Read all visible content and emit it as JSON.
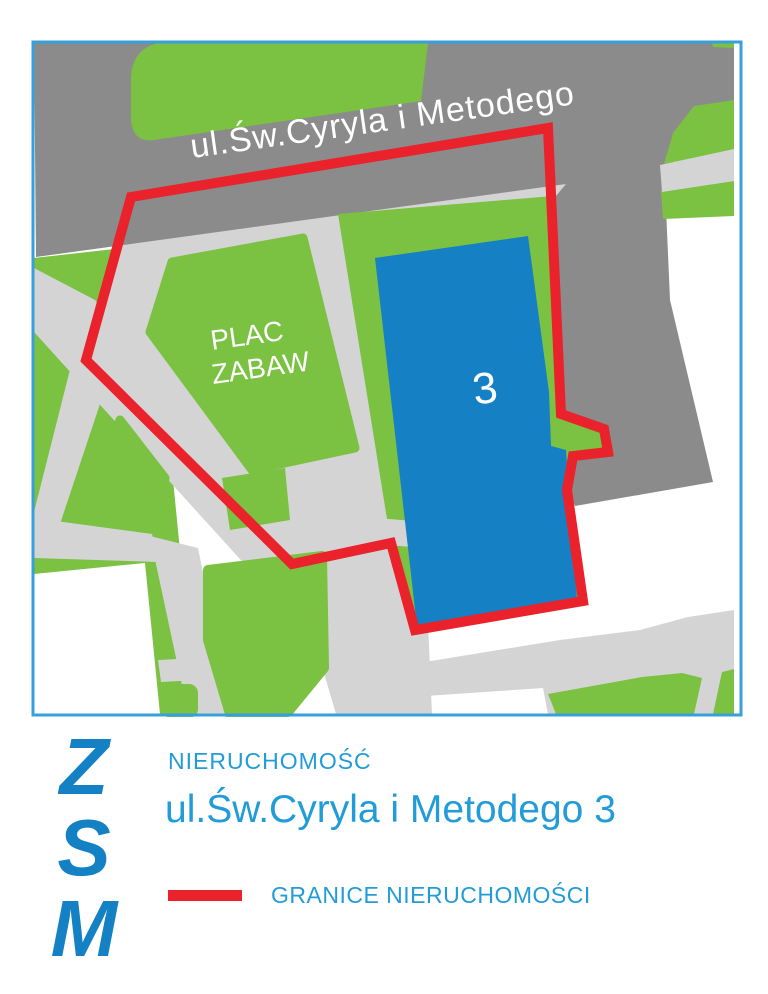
{
  "map": {
    "street_label": "ul.Św.Cyryla i Metodego",
    "park_label_line1": "PLAC",
    "park_label_line2": "ZABAW",
    "building_number": "3"
  },
  "footer": {
    "logo": "Z\nS\nM",
    "property_label": "NIERUCHOMOŚĆ",
    "property_address": "ul.Św.Cyryla i Metodego 3",
    "legend_label": "GRANICE NIERUCHOMOŚCI"
  },
  "colors": {
    "background": "#FFFFFF",
    "street": "#8B8B8B",
    "path": "#D4D4D4",
    "green": "#7BC142",
    "building": "#1580C4",
    "red": "#E9222B",
    "map_border": "#36A0DC",
    "text_blue": "#219CD9",
    "zsm_blue": "#1581C5"
  }
}
